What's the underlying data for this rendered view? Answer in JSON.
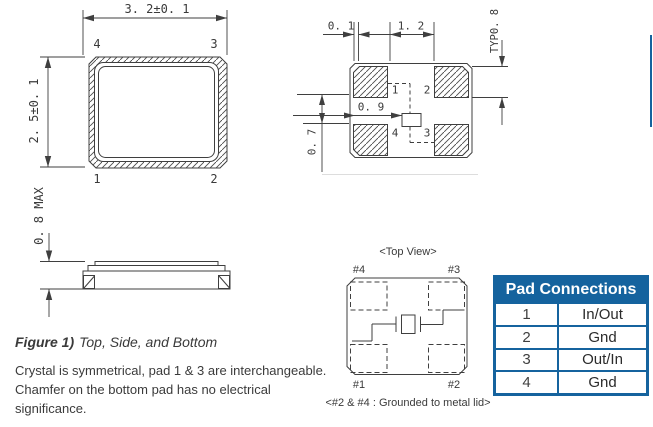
{
  "colors": {
    "accent_blue": "#15639E",
    "line_gray": "#3f3f3f"
  },
  "package_top_view": {
    "dim_width": "3. 2±0. 1",
    "dim_height": "2. 5±0. 1",
    "pad_top_left": "4",
    "pad_top_right": "3",
    "pad_bottom_left": "1",
    "pad_bottom_right": "2"
  },
  "side_view": {
    "dim_height": "0. 8 MAX"
  },
  "land_pattern": {
    "dim_edge_gap": "0. 1",
    "dim_center_gap": "1. 2",
    "dim_pad_height": "TYP0. 8",
    "dim_chamfer_offset": "0. 9",
    "dim_row_gap": "0. 7",
    "pad_top_left": "1",
    "pad_top_right": "2",
    "pad_bottom_left": "4",
    "pad_bottom_right": "3"
  },
  "internal_top_view": {
    "title": "<Top View>",
    "pad_top_left": "#4",
    "pad_top_right": "#3",
    "pad_bottom_left": "#1",
    "pad_bottom_right": "#2",
    "note": "<#2 & #4 : Grounded to metal lid>"
  },
  "caption": {
    "label": "Figure 1)",
    "title": "Top, Side, and Bottom"
  },
  "description": {
    "lines": [
      "Crystal is symmetrical, pad 1 & 3 are interchangeable.",
      "Chamfer on the bottom pad has no electrical",
      "significance."
    ]
  },
  "pad_table": {
    "title": "Pad Connections",
    "rows": [
      {
        "pad": "1",
        "connection": "In/Out"
      },
      {
        "pad": "2",
        "connection": "Gnd"
      },
      {
        "pad": "3",
        "connection": "Out/In"
      },
      {
        "pad": "4",
        "connection": "Gnd"
      }
    ]
  }
}
